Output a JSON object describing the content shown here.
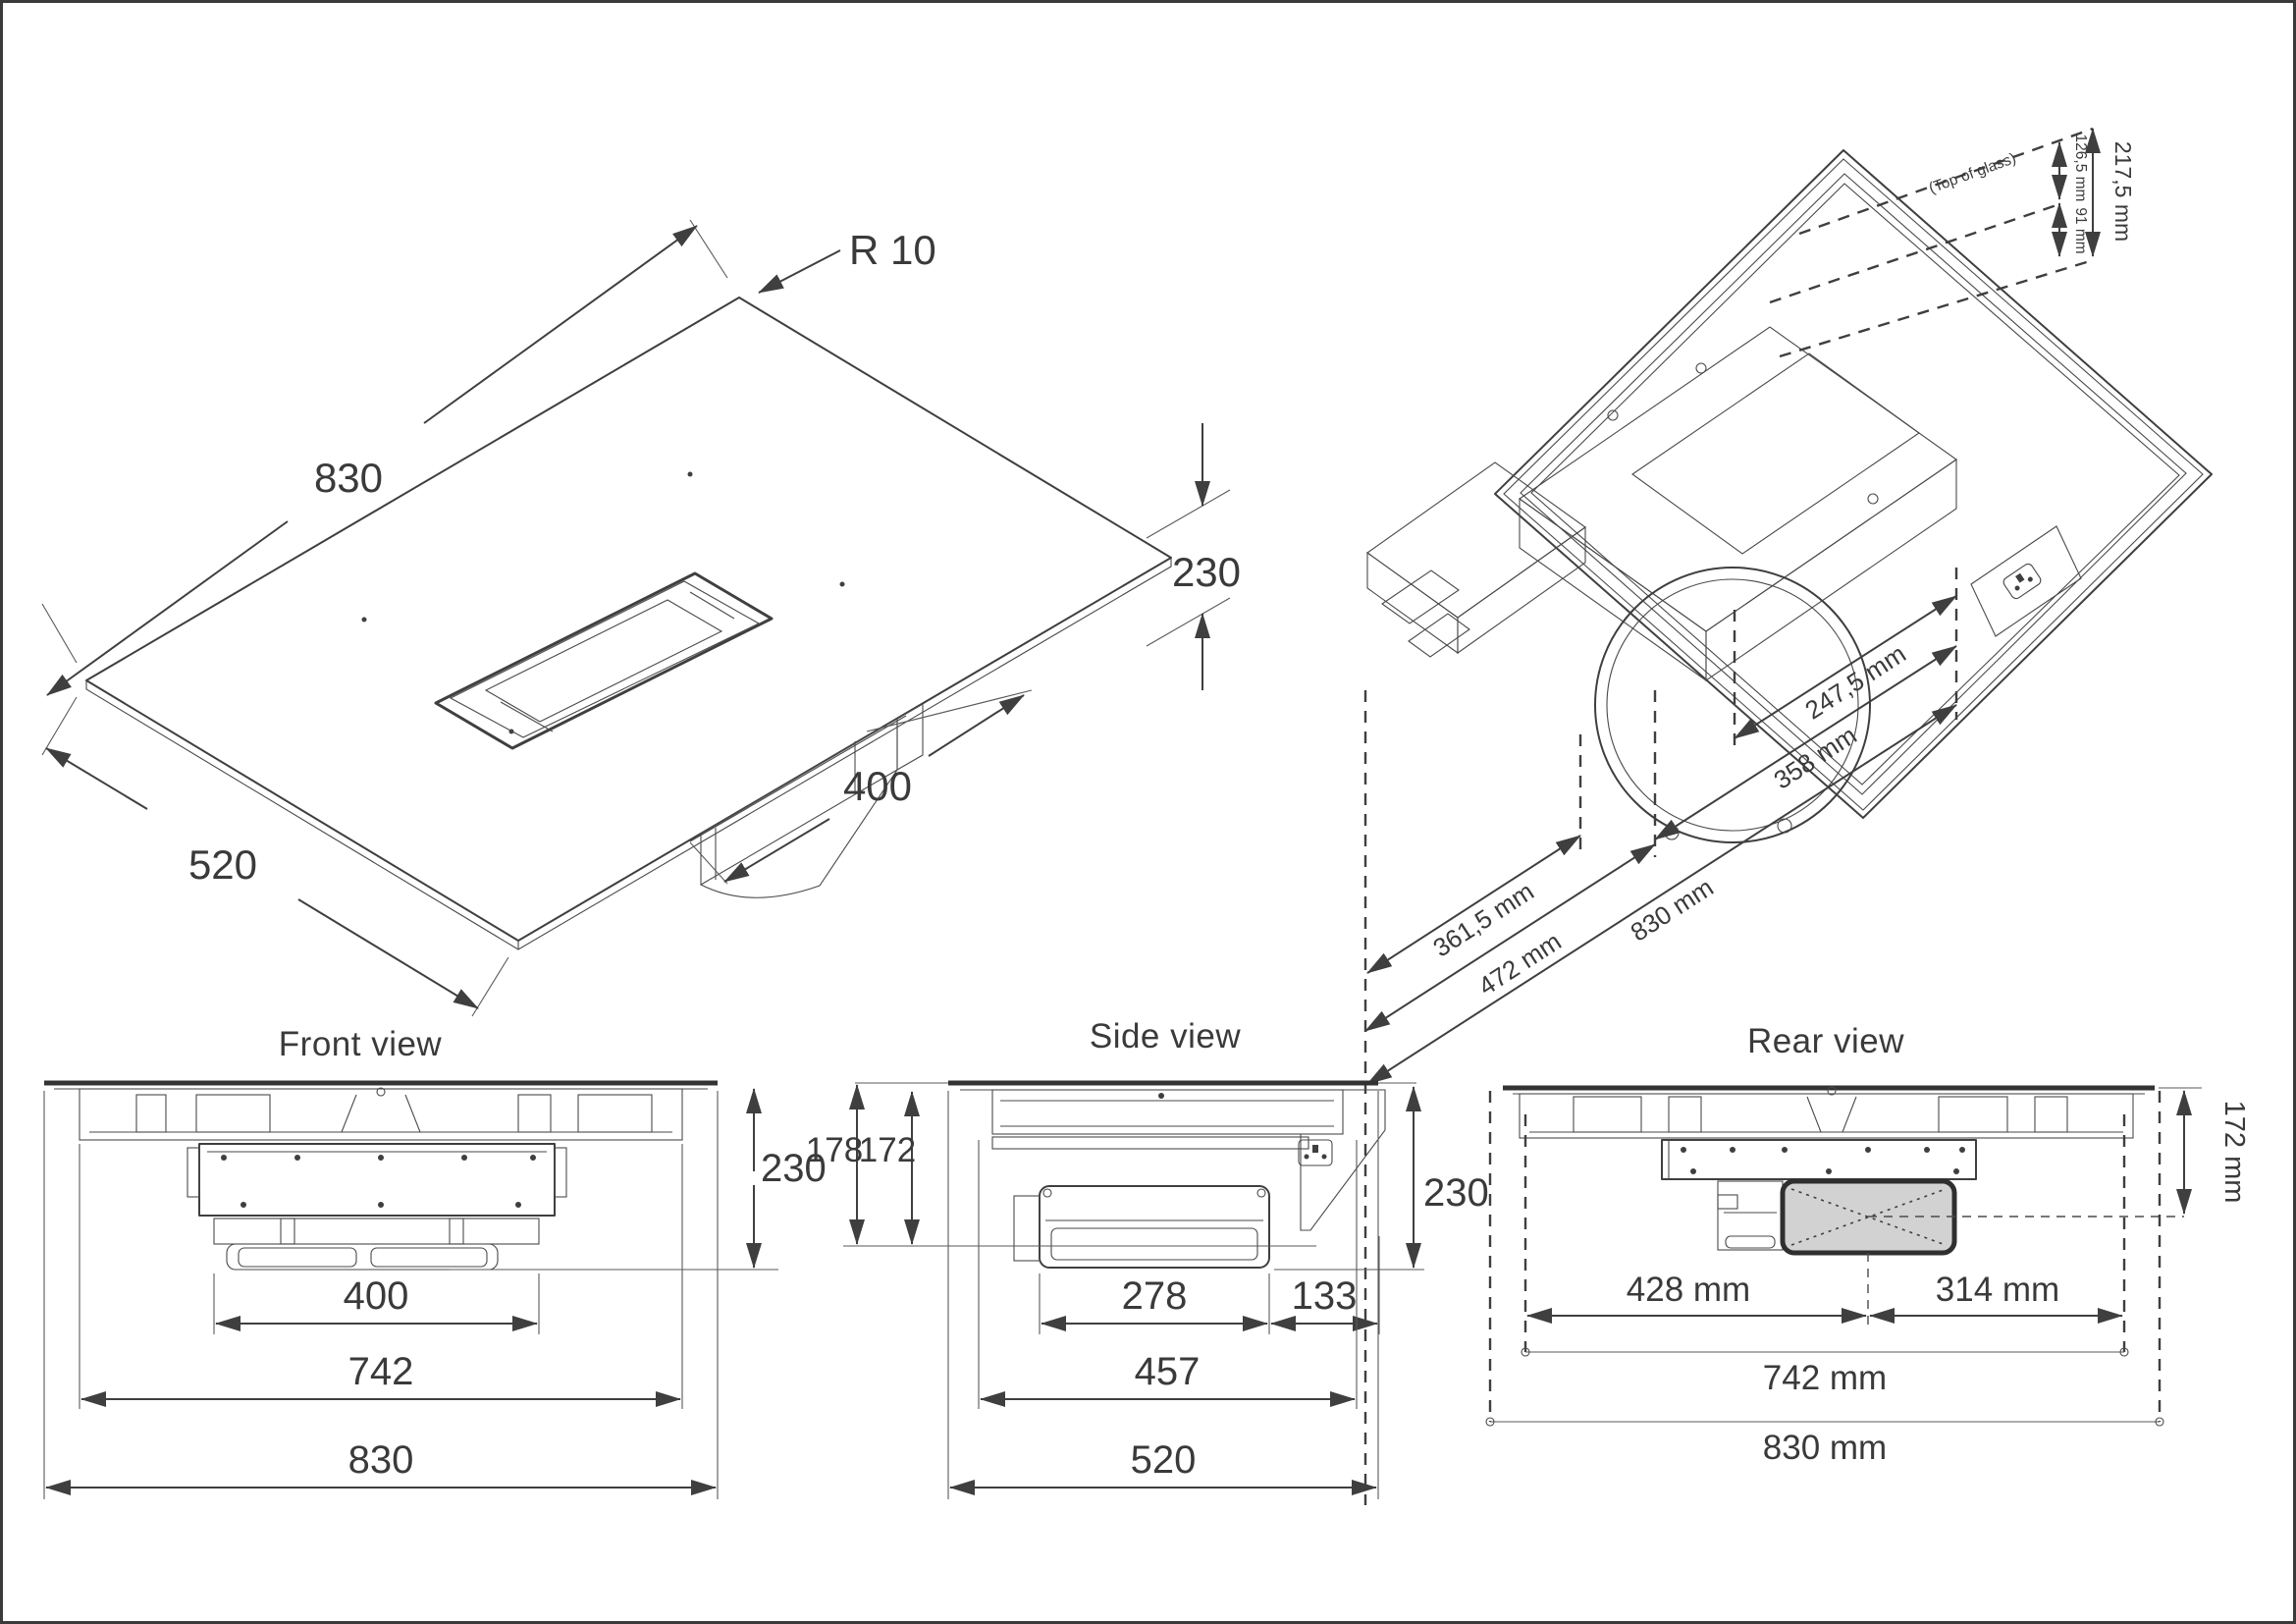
{
  "drawing": {
    "titles": {
      "front": "Front view",
      "side": "Side view",
      "rear": "Rear view"
    },
    "colors": {
      "line": "#3f3f3f",
      "text": "#3a3a3a",
      "duct_fill": "#d2d2d2",
      "background": "#ffffff",
      "border": "#3a3a3a"
    },
    "iso_top": {
      "corner_radius": "R 10",
      "length": "830",
      "height": "230",
      "depth": "520",
      "vent_length": "400"
    },
    "iso_bottom": {
      "note_top_of_glass": "(Top of glass)",
      "height_total": "217,5 mm",
      "height_upper": "126,5 mm",
      "height_lower": "91 mm",
      "offset_fan_axis": "247,5 mm",
      "span_fan": "358 mm",
      "offset_duct": "361,5 mm",
      "span_duct": "472 mm",
      "length_total": "830 mm"
    },
    "front": {
      "height": "230",
      "vent_width": "400",
      "body_width": "742",
      "total_width": "830"
    },
    "side": {
      "height_front_flange": "178",
      "height_under_glass": "172",
      "height_total": "230",
      "fan_depth": "278",
      "rear_gap": "133",
      "body_depth": "457",
      "total_depth": "520"
    },
    "rear": {
      "duct_axis_height": "172 mm",
      "left_to_duct_axis": "428 mm",
      "duct_axis_to_right": "314 mm",
      "body_width": "742 mm",
      "total_width": "830 mm"
    }
  }
}
